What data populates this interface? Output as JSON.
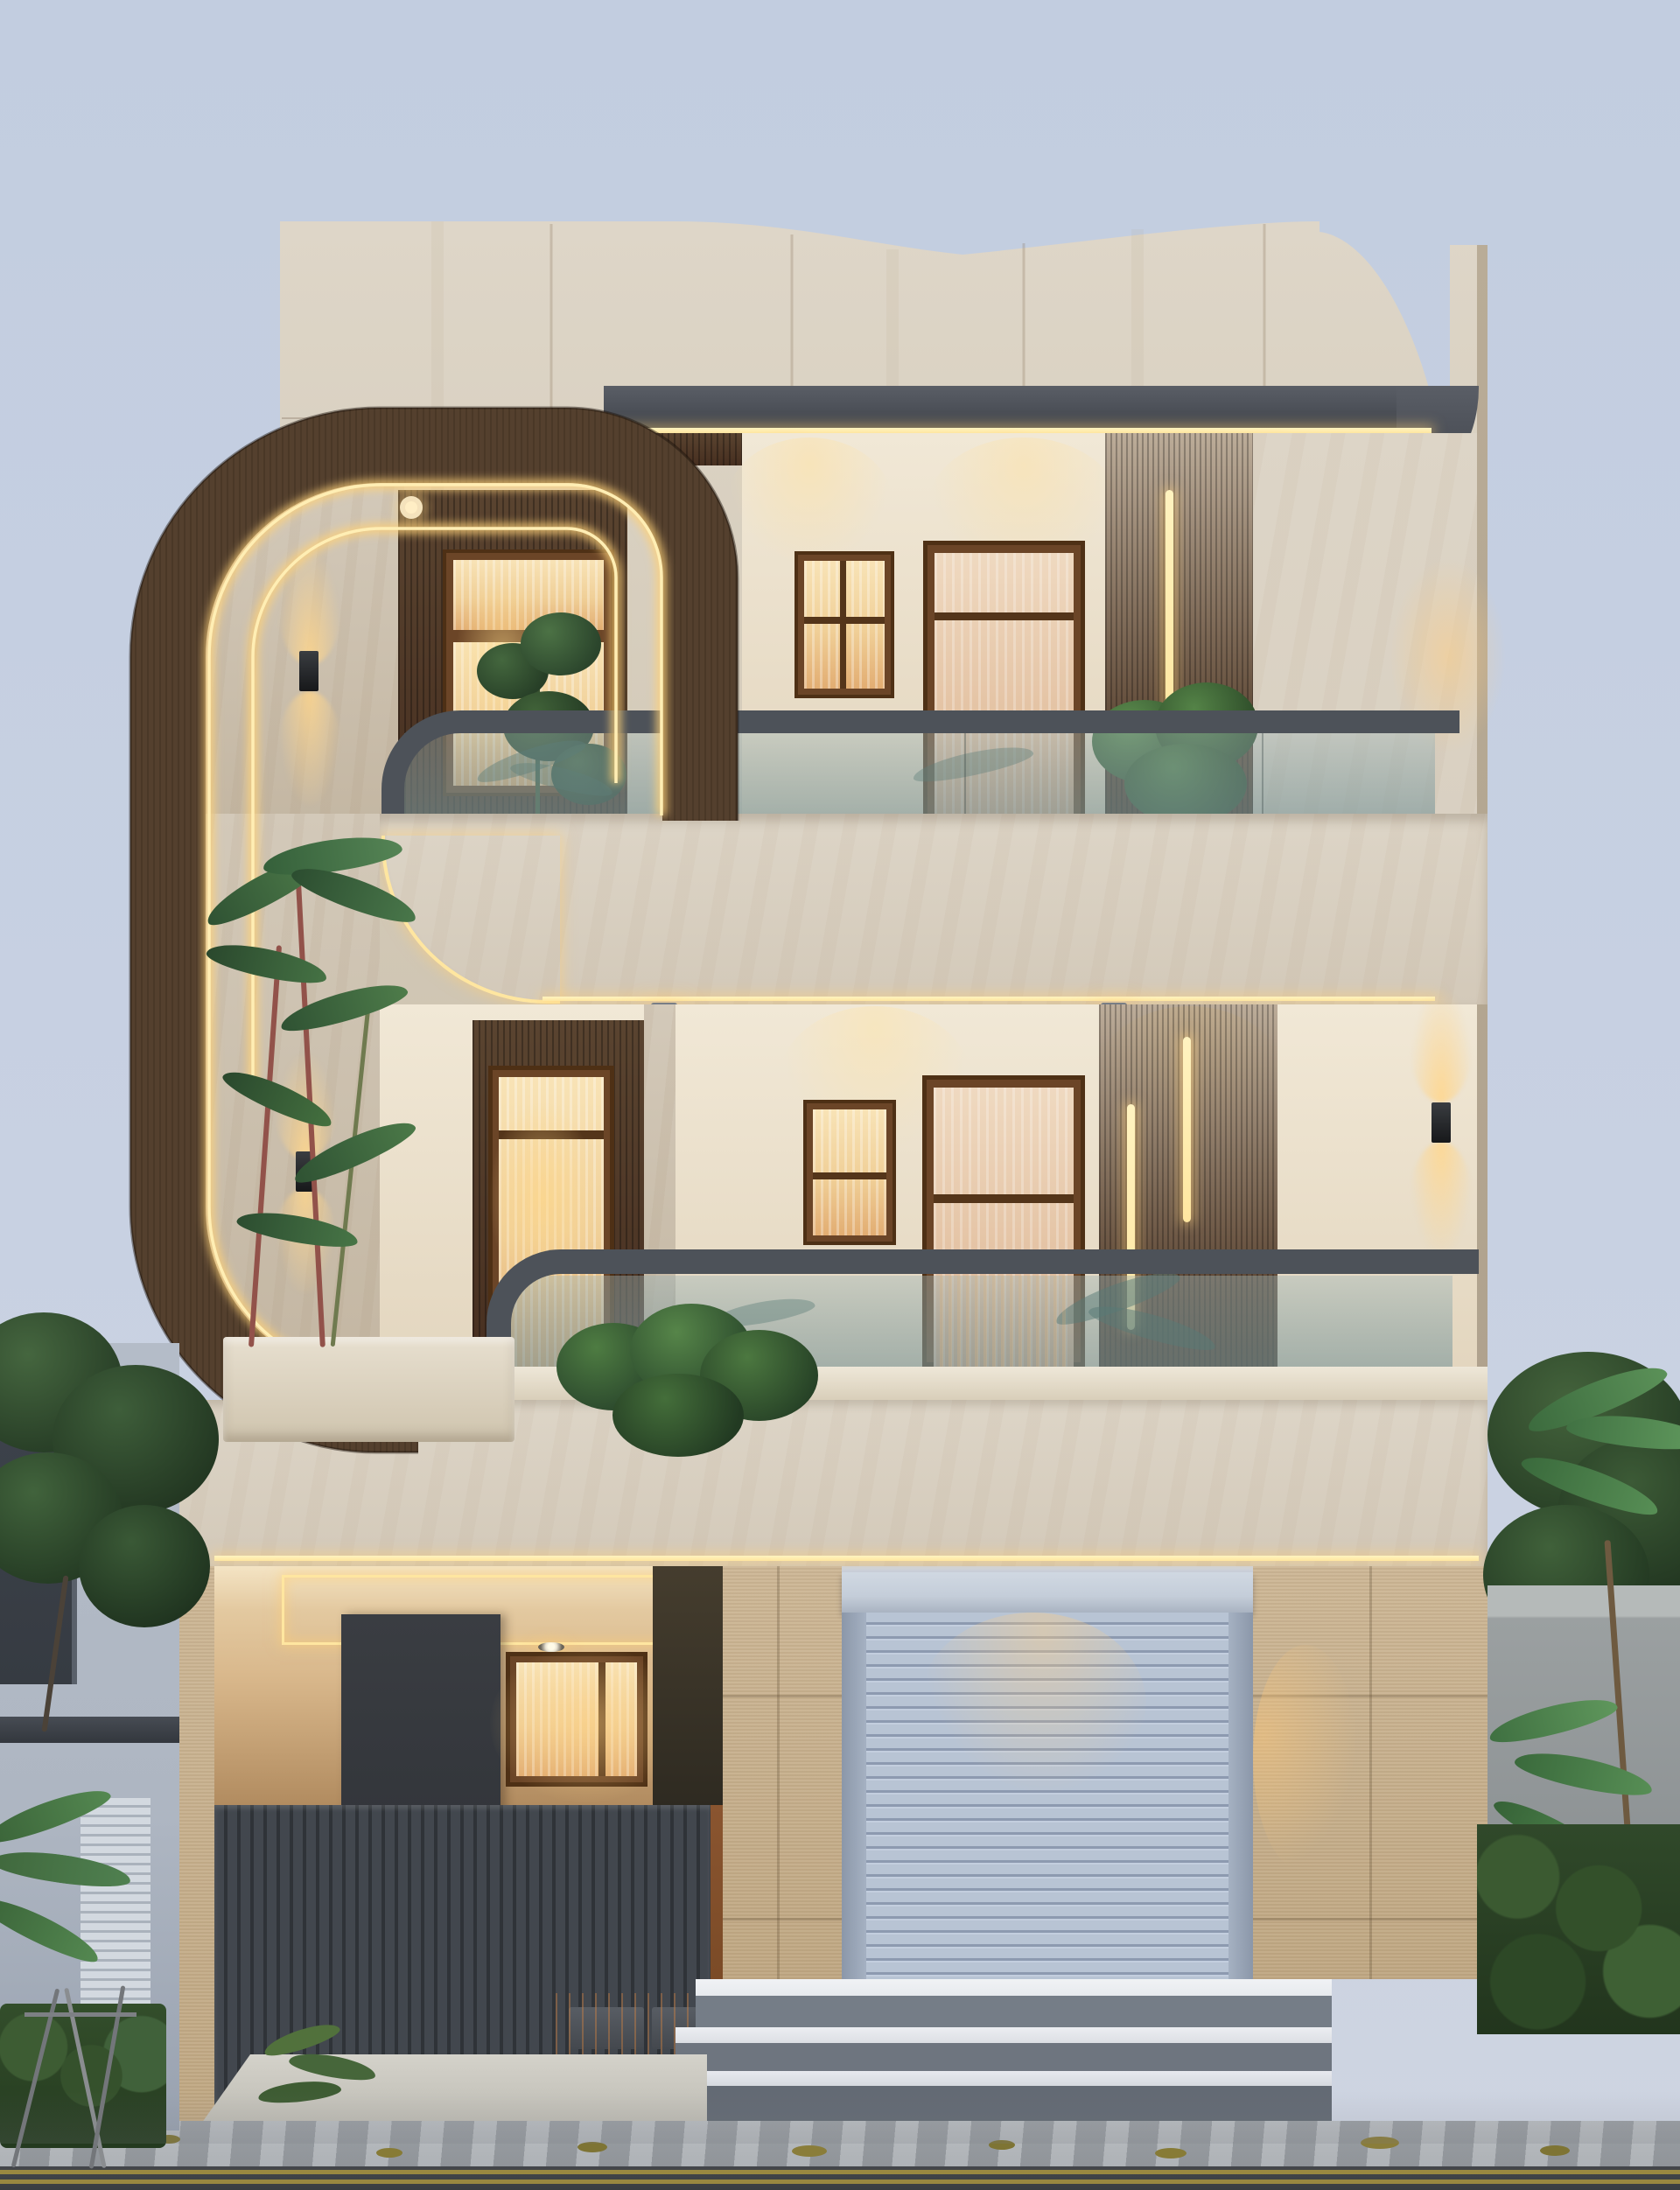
{
  "scene": {
    "type": "architectural-exterior-render",
    "title": "Modern three-storey house facade at dusk",
    "time_of_day": "dusk",
    "elements": {
      "parapet": "curved travertine parapet with stepped concave top and right pillar",
      "wood_feature_frame": "large rounded dark-wood C-frame with twin warm LED coves, spanning two floors on the left",
      "roof_eave": "dark grey fascia with warm LED strip, wooden soffit and recessed downlights",
      "floor_1": "upper balcony: lit window, four-pane window, curtained door, wood slat panel with vertical LED bar, glass railing with grey handrail, plants",
      "floor_2": "middle balcony: curtained door with transom, two-pane window, second curtained door, wood slat panel with two LED bars, glass railing, palm plants, marble planter, up/down wall sconces",
      "ground_floor": "entrance porch with warm cove-lit ceiling, dark feature wall, lit window, grey slatted gate with handles, speckled tan tile piers, rolling shutter garage with hood, three wide steps",
      "environment": "neighbouring house and trees on the left, compound wall, hedge and palms on the right, asphalt road with double yellow line and scattered leaves"
    },
    "lighting": [
      "warm LED coves along wood frame",
      "soffit downlights",
      "up-down wall sconces",
      "vertical LED bars on slat panels",
      "porch ceiling LED rectangle",
      "glow on rolling shutter"
    ]
  },
  "theme_colors": {
    "sky-top": "#c2cde0",
    "sky-mid": "#c8d1e2",
    "sky-bottom": "#ced4e1",
    "marble-hi": "#ddd5c7",
    "marble": "#d3c9b9",
    "marble-dk": "#c4b7a3",
    "marble-side": "#b9ac97",
    "fascia": "#50545c",
    "fascia-dk": "#41454c",
    "led": "#ffe6a0",
    "led-glow": "rgba(255,208,118,0.55)",
    "wood": "#54402e",
    "wood-dk": "#3b2b1e",
    "soffit-hi": "#5a4430",
    "soffit": "#472f20",
    "slat-hi": "#55382356",
    "slat": "#452e1d",
    "frame-wood": "#6b4527",
    "curtain-hi": "#f8e3b6",
    "curtain": "#f0cf97",
    "curtain-dk": "#e2ad72",
    "curtain2-hi": "#efd9c0",
    "curtain2": "#e4c3a4",
    "curtain2-dk": "#d4a887",
    "wall": "#f1e8d6",
    "wall-dk": "#e3d6bf",
    "rail": "#4d5259",
    "tan-hi": "#cdb796",
    "tan": "#c0a883",
    "gate": "#42474e",
    "gate-dk": "#2f3338",
    "darkbox": "#33363b",
    "porch-warm": "#d9b88c",
    "porch-ceil": "#f4e4c4",
    "shutter-hi": "#b8c4d4",
    "shutter": "#a3b0c4",
    "hood": "#c4cdd9",
    "step-tread": "#e7eaee",
    "step-riser": "#757d87",
    "road": "#3a3d41",
    "road-line": "#a9943f",
    "curb": "#9da2a7",
    "walk": "#c9c8c2",
    "green": "#3c5c39",
    "green-dk": "#2b452c",
    "green-lt": "#527e47",
    "palm": "#4e8049",
    "stem-red": "#92524a",
    "neighbor": "#aeb6c2",
    "neighbor-dk": "#363b42",
    "wallgray": "#9ba0a1"
  }
}
